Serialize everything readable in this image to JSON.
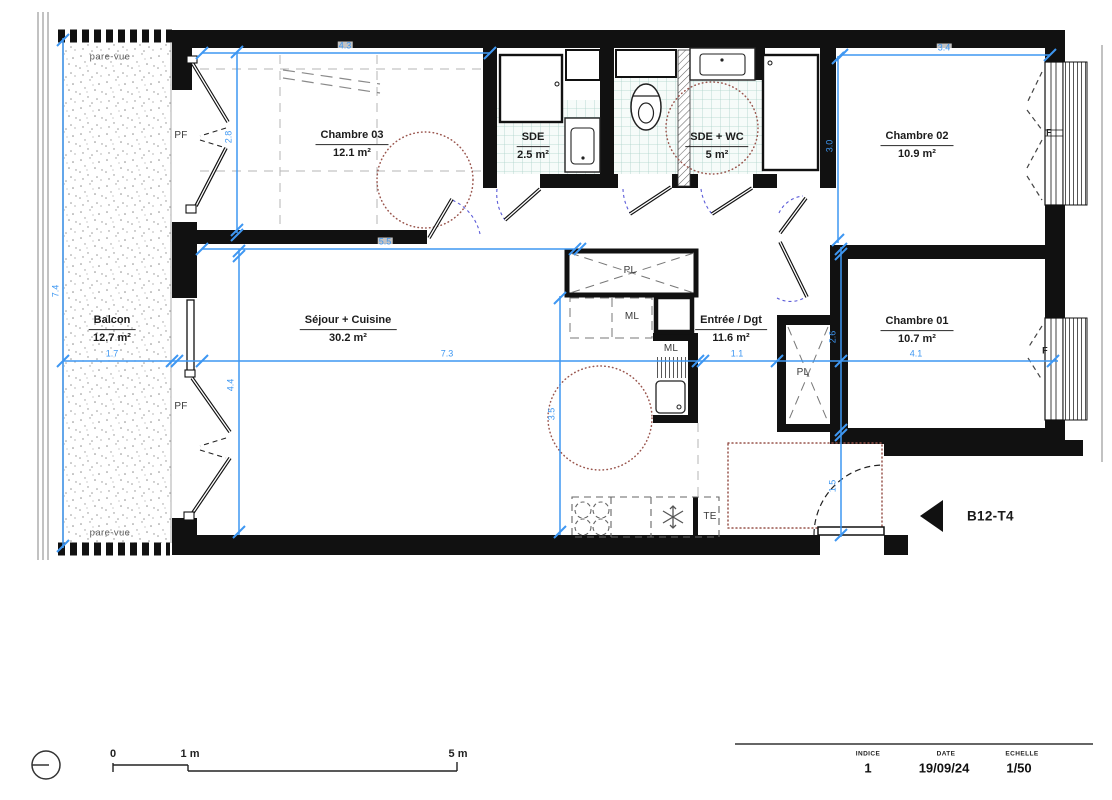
{
  "plan": {
    "unit_label": "B12-T4",
    "rooms": [
      {
        "id": "chambre03",
        "name": "Chambre 03",
        "area": "12.1 m²"
      },
      {
        "id": "sde",
        "name": "SDE",
        "area": "2.5 m²"
      },
      {
        "id": "sde_wc",
        "name": "SDE + WC",
        "area": "5 m²"
      },
      {
        "id": "chambre02",
        "name": "Chambre 02",
        "area": "10.9 m²"
      },
      {
        "id": "balcon",
        "name": "Balcon",
        "area": "12.7 m²"
      },
      {
        "id": "sejour",
        "name": "Séjour + Cuisine",
        "area": "30.2 m²"
      },
      {
        "id": "entree",
        "name": "Entrée / Dgt",
        "area": "11.6 m²"
      },
      {
        "id": "chambre01",
        "name": "Chambre 01",
        "area": "10.7 m²"
      }
    ],
    "dimensions_m": [
      {
        "id": "w_ch03",
        "value": "4.3"
      },
      {
        "id": "w_ch02",
        "value": "3.4"
      },
      {
        "id": "h_ch03",
        "value": "2.8"
      },
      {
        "id": "h_ch02",
        "value": "3.0"
      },
      {
        "id": "w_sejour_top",
        "value": "5.5"
      },
      {
        "id": "w_balcon",
        "value": "1.7"
      },
      {
        "id": "w_sejour",
        "value": "7.3"
      },
      {
        "id": "w_entree",
        "value": "1.1"
      },
      {
        "id": "w_ch01",
        "value": "4.1"
      },
      {
        "id": "h_sejour",
        "value": "4.4"
      },
      {
        "id": "h_kitchen",
        "value": "3.5"
      },
      {
        "id": "h_ch01",
        "value": "2.6"
      },
      {
        "id": "h_entry",
        "value": "1.5"
      },
      {
        "id": "h_balcon",
        "value": "7.4"
      }
    ],
    "tags": [
      {
        "id": "parevue_top",
        "text": "pare-vue"
      },
      {
        "id": "parevue_bottom",
        "text": "pare-vue"
      },
      {
        "id": "pf_top",
        "text": "PF"
      },
      {
        "id": "pf_bottom",
        "text": "PF"
      },
      {
        "id": "pl_hall",
        "text": "PL"
      },
      {
        "id": "pl_entree",
        "text": "PL"
      },
      {
        "id": "ml_top",
        "text": "ML"
      },
      {
        "id": "ml_sink",
        "text": "ML"
      },
      {
        "id": "te",
        "text": "TE"
      },
      {
        "id": "f_ch02",
        "text": "F"
      },
      {
        "id": "f_ch01",
        "text": "F"
      }
    ],
    "scale_bar": {
      "start": "0",
      "mid": "1 m",
      "end": "5 m"
    },
    "title_block": {
      "indice_label": "INDICE",
      "indice_value": "1",
      "date_label": "DATE",
      "date_value": "19/09/24",
      "scale_label": "ECHELLE",
      "scale_value": "1/50"
    },
    "colors": {
      "wall": "#111111",
      "dimension": "#3E97F2",
      "door_swing": "#5C5CD8",
      "tile_grid": "#ACD2CA",
      "turning_circle": "#9A564E"
    }
  }
}
